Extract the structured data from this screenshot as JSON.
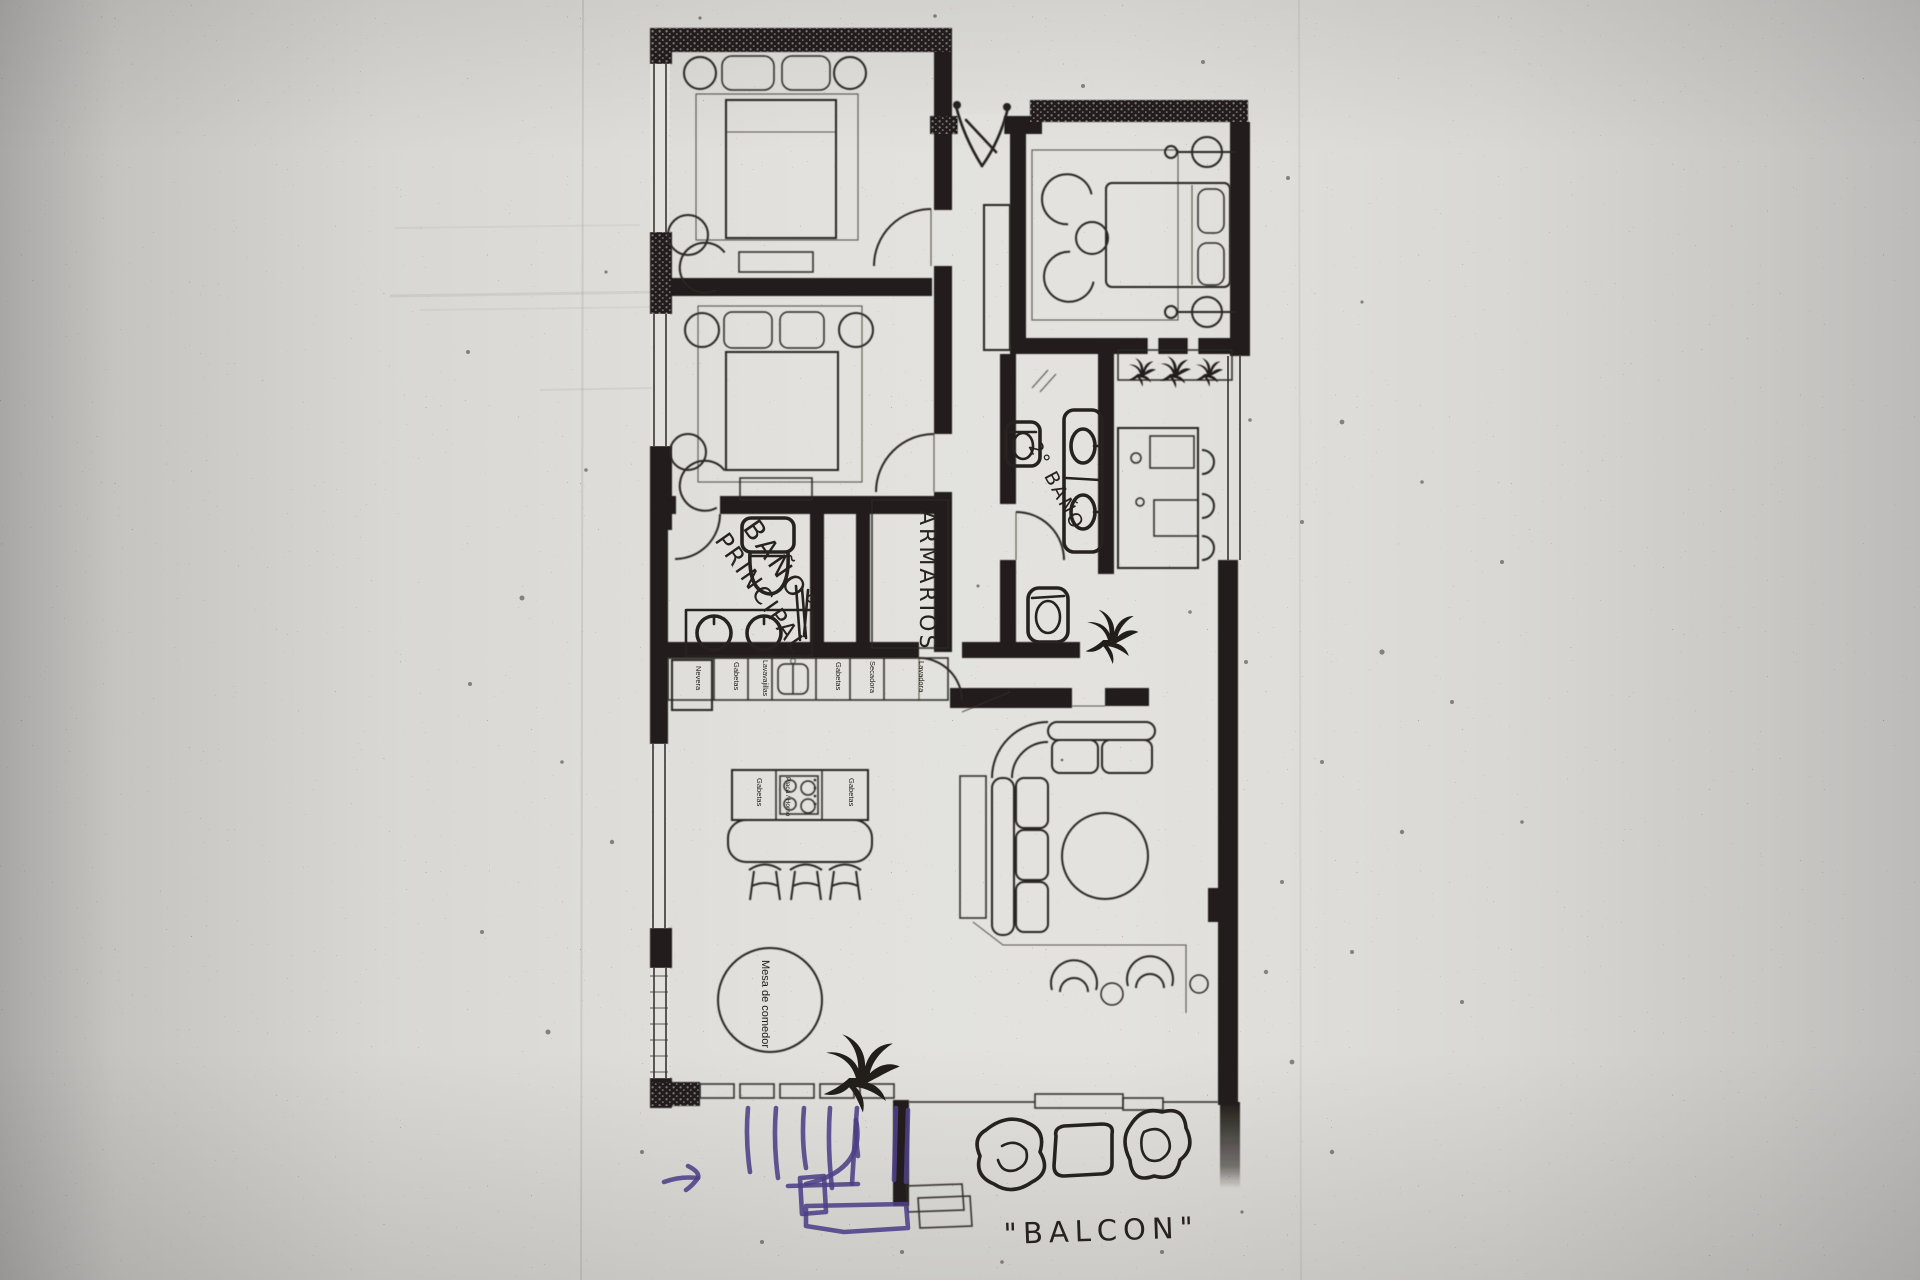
{
  "floor_plan": {
    "handwritten_labels": {
      "main_bathroom_line1": "BAÑO°",
      "main_bathroom_line2": "PRINCIPAL",
      "wardrobes": "ARMARIOS",
      "second_bathroom": "2° BAÑO",
      "balcony": "\"BALCON\""
    },
    "printed_labels": {
      "appliance_row": [
        "Nevera",
        "Gabetas",
        "Lavavajillas",
        "Gabetas",
        "Secadora",
        "Lavadora"
      ],
      "island_cells": [
        "Gabetas",
        "Placa / Horno",
        "Gabetas"
      ],
      "dining_table": "Mesa de comedor"
    },
    "colors": {
      "ink": "#262220",
      "annotation_purple": "#4e4088",
      "paper": "#e2e1dd"
    }
  }
}
